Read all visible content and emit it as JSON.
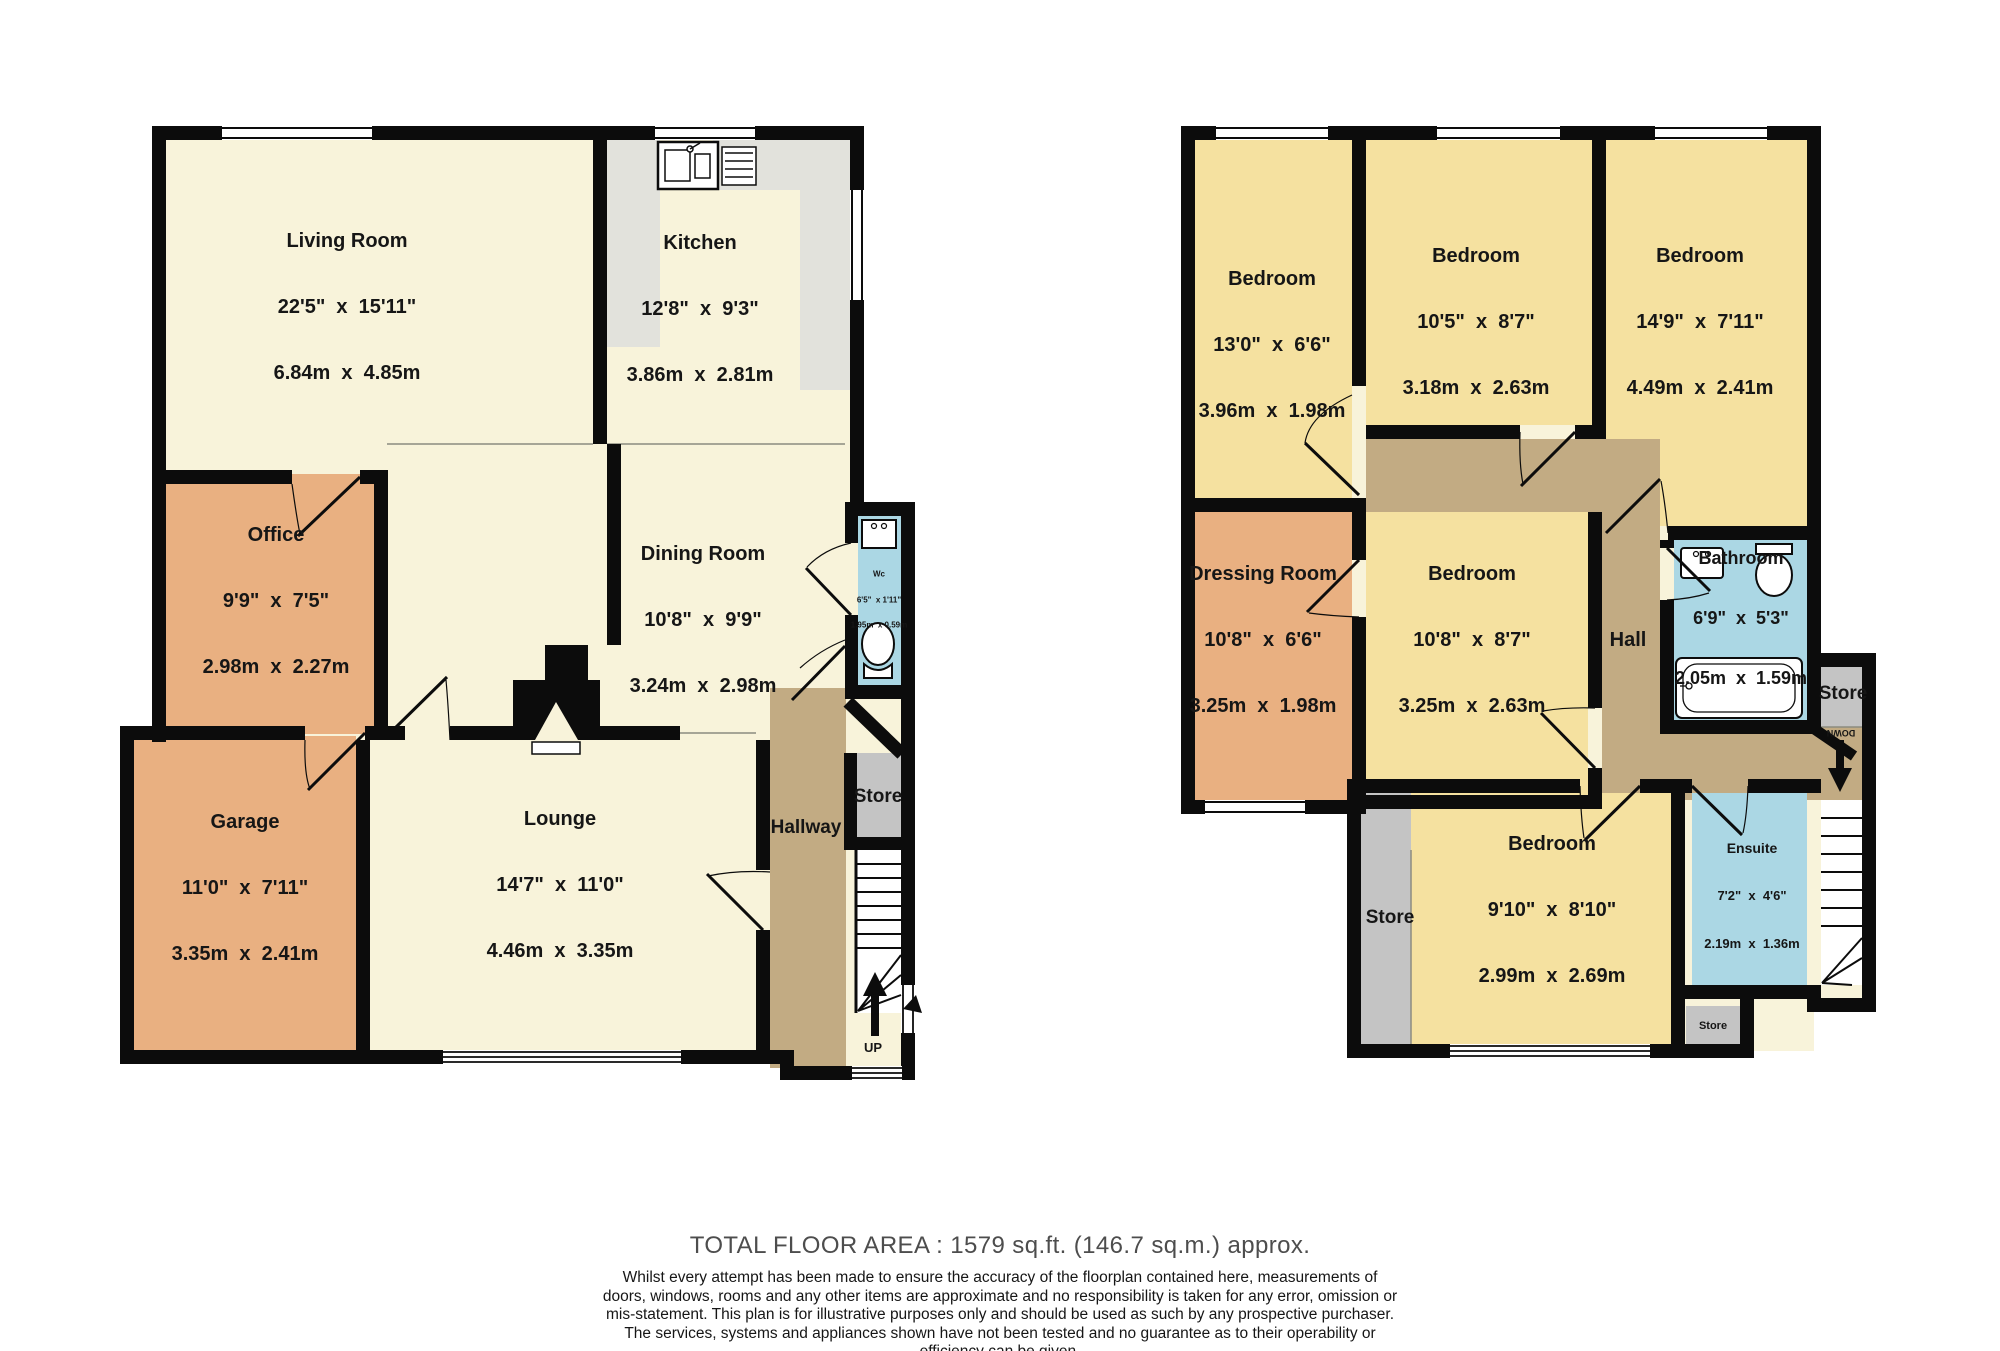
{
  "colors": {
    "cream": "#f8f3da",
    "bedroom_yellow": "#f5e1a0",
    "orange": "#e9b081",
    "hall_brown": "#c2ab83",
    "wet_blue": "#abd7e4",
    "store_gray": "#c4c4c4",
    "counter_gray": "#e2e2dc",
    "wall": "#0c0c0c"
  },
  "ground_floor": {
    "living_room": {
      "name": "Living Room",
      "imperial": "22'5\"  x  15'11\"",
      "metric": "6.84m  x  4.85m"
    },
    "kitchen": {
      "name": "Kitchen",
      "imperial": "12'8\"  x  9'3\"",
      "metric": "3.86m  x  2.81m"
    },
    "office": {
      "name": "Office",
      "imperial": "9'9\"  x  7'5\"",
      "metric": "2.98m  x  2.27m"
    },
    "dining_room": {
      "name": "Dining Room",
      "imperial": "10'8\"  x  9'9\"",
      "metric": "3.24m  x  2.98m"
    },
    "garage": {
      "name": "Garage",
      "imperial": "11'0\"  x  7'11\"",
      "metric": "3.35m  x  2.41m"
    },
    "lounge": {
      "name": "Lounge",
      "imperial": "14'7\"  x  11'0\"",
      "metric": "4.46m  x  3.35m"
    },
    "hallway": {
      "name": "Hallway"
    },
    "store": {
      "name": "Store"
    },
    "wc": {
      "name": "Wc",
      "imperial": "6'5\"  x 1'11\"",
      "metric": "1.95m  x 0.59m"
    },
    "up_label": "UP"
  },
  "first_floor": {
    "bedroom_1": {
      "name": "Bedroom",
      "imperial": "13'0\"  x  6'6\"",
      "metric": "3.96m  x  1.98m"
    },
    "bedroom_2": {
      "name": "Bedroom",
      "imperial": "10'5\"  x  8'7\"",
      "metric": "3.18m  x  2.63m"
    },
    "bedroom_3": {
      "name": "Bedroom",
      "imperial": "14'9\"  x  7'11\"",
      "metric": "4.49m  x  2.41m"
    },
    "dressing_room": {
      "name": "Dressing Room",
      "imperial": "10'8\"  x  6'6\"",
      "metric": "3.25m  x  1.98m"
    },
    "bedroom_4": {
      "name": "Bedroom",
      "imperial": "10'8\"  x  8'7\"",
      "metric": "3.25m  x  2.63m"
    },
    "hall": {
      "name": "Hall"
    },
    "bathroom": {
      "name": "Bathroom",
      "imperial": "6'9\"  x  5'3\"",
      "metric": "2.05m  x  1.59m"
    },
    "store_landing": {
      "name": "Store"
    },
    "ensuite": {
      "name": "Ensuite",
      "imperial": "7'2\"  x  4'6\"",
      "metric": "2.19m  x  1.36m"
    },
    "bedroom_5": {
      "name": "Bedroom",
      "imperial": "9'10\"  x  8'10\"",
      "metric": "2.99m  x  2.69m"
    },
    "store_left": {
      "name": "Store"
    },
    "store_small": {
      "name": "Store"
    },
    "down_label": "DOWN"
  },
  "footer": {
    "total_area": "TOTAL FLOOR AREA : 1579 sq.ft. (146.7 sq.m.) approx.",
    "disclaimer": "Whilst every attempt has been made to ensure the accuracy of the floorplan contained here, measurements of doors, windows, rooms and any other items are approximate and no responsibility is taken for any error, omission or mis-statement. This plan is for illustrative purposes only and should be used as such by any prospective purchaser. The services, systems and appliances shown have not been tested and no guarantee as to their operability or efficiency can be given.",
    "credit": "Made with Metropix ©2025"
  }
}
